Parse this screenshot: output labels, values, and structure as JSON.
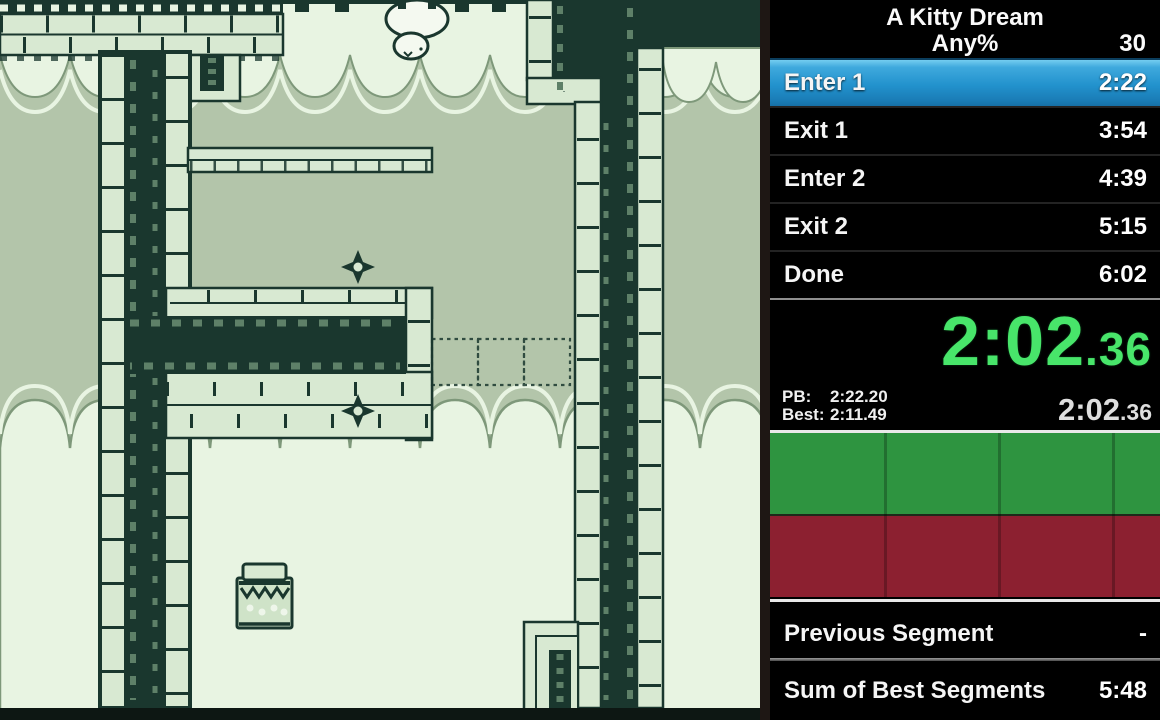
{
  "game": {
    "style": "gameboy-platformer",
    "palette": {
      "bg_mid": "#b3c5aa",
      "bg_light": "#e8f4e2",
      "wall_dark": "#1a372e",
      "brick_light": "#d8e9d2",
      "moss_fleck": "#5e8068",
      "sprite_white": "#f4f9f0"
    },
    "sprites": {
      "cat": "white-cat-falling",
      "diamond_count": 2,
      "jar": "collectible-jar",
      "ghost_block_count": 3
    }
  },
  "timer": {
    "game_title": "A Kitty Dream",
    "category": "Any%",
    "attempts": "30",
    "segments": [
      {
        "name": "Enter 1",
        "time": "2:22",
        "active": true
      },
      {
        "name": "Exit 1",
        "time": "3:54",
        "active": false
      },
      {
        "name": "Enter 2",
        "time": "4:39",
        "active": false
      },
      {
        "name": "Exit 2",
        "time": "5:15",
        "active": false
      },
      {
        "name": "Done",
        "time": "6:02",
        "active": false
      }
    ],
    "active_segment_color": "#2292cd",
    "main_timer": {
      "main": "2:02",
      "fraction": ".36",
      "color": "#48e56a"
    },
    "comparison": {
      "pb_label": "PB:",
      "pb_value": "2:22.20",
      "best_label": "Best:",
      "best_value": "2:11.49"
    },
    "sub_timer": {
      "main": "2:02",
      "fraction": ".36"
    },
    "graph": {
      "columns": 4,
      "top_color": "#2e9440",
      "bottom_color": "#8c2030"
    },
    "footer": [
      {
        "label": "Previous Segment",
        "value": "-"
      },
      {
        "label": "Sum of Best Segments",
        "value": "5:48"
      }
    ]
  }
}
